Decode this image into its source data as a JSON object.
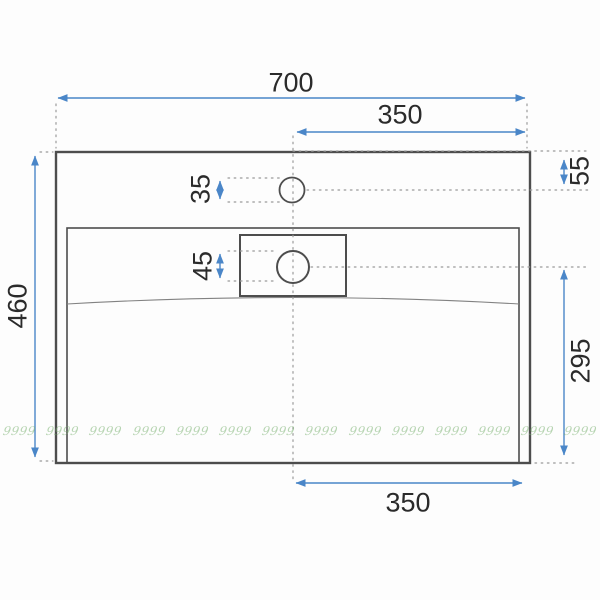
{
  "drawing": {
    "type": "sink-technical-drawing",
    "colors": {
      "dimension_blue": "#4a86c8",
      "outline_dark": "#4d4d4d",
      "text_dark": "#2b2b2b",
      "dotted_gray": "#9a9a9a",
      "watermark_green": "#7cb272",
      "background": "#fdfdfd"
    },
    "dimensions": {
      "overall_width": "700",
      "center_to_right_top": "350",
      "overall_depth": "460",
      "faucet_hole_offset_from_top": "55",
      "faucet_hole_diameter": "35",
      "drain_diameter": "45",
      "drain_center_to_front": "295",
      "center_to_right_bottom": "350"
    }
  },
  "watermark": {
    "text": "9999",
    "count": 14
  }
}
